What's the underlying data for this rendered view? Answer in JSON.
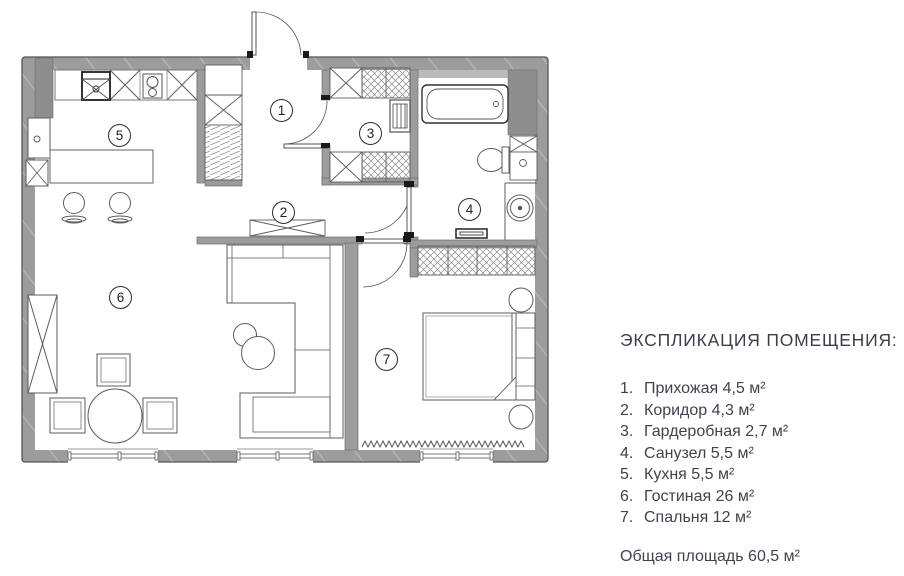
{
  "legend": {
    "title": "ЭКСПЛИКАЦИЯ ПОМЕЩЕНИЯ:",
    "items": [
      {
        "num": "1.",
        "label": "Прихожая 4,5 м²"
      },
      {
        "num": "2.",
        "label": "Коридор 4,3 м²"
      },
      {
        "num": "3.",
        "label": "Гардеробная 2,7 м²"
      },
      {
        "num": "4.",
        "label": "Санузел 5,5 м²"
      },
      {
        "num": "5.",
        "label": "Кухня 5,5 м²"
      },
      {
        "num": "6.",
        "label": "Гостиная 26 м²"
      },
      {
        "num": "7.",
        "label": "Спальня 12 м²"
      }
    ],
    "total": "Общая площадь 60,5 м²"
  },
  "plan": {
    "room_numbers": [
      "1",
      "2",
      "3",
      "4",
      "5",
      "6",
      "7"
    ],
    "total_area": "60,5 м²",
    "colors": {
      "wall": "#9c9c9c",
      "wall_dark": "#8e8e8e",
      "line": "#5c5c5c",
      "text": "#3e434d"
    }
  }
}
